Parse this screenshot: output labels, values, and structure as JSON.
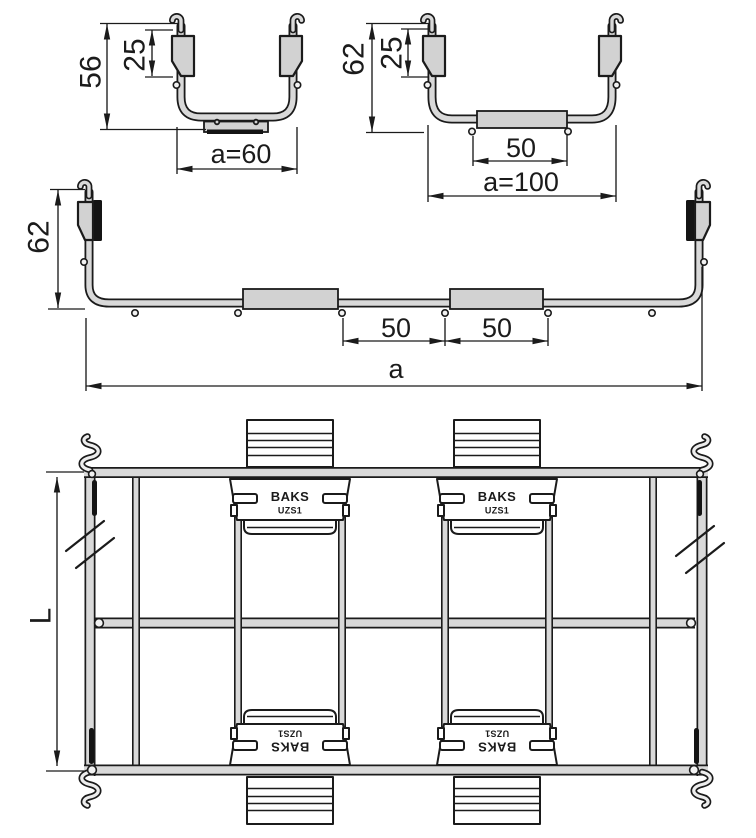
{
  "drawing": {
    "colors": {
      "outline": "#1b1b1b",
      "wire_fill": "#d9d9d9",
      "plate_fill": "#d2d2d2",
      "background": "#ffffff"
    },
    "section_small": {
      "height": "56",
      "clamp_height": "25",
      "width": "a=60"
    },
    "section_medium": {
      "height": "62",
      "clamp_height": "25",
      "plate_width": "50",
      "width": "a=100"
    },
    "section_wide": {
      "height": "62",
      "wire_spacing_1": "50",
      "wire_spacing_2": "50",
      "width": "a"
    },
    "plan_view": {
      "length": "L",
      "clamp_brand": "BAKS",
      "clamp_model": "UZS1"
    }
  }
}
